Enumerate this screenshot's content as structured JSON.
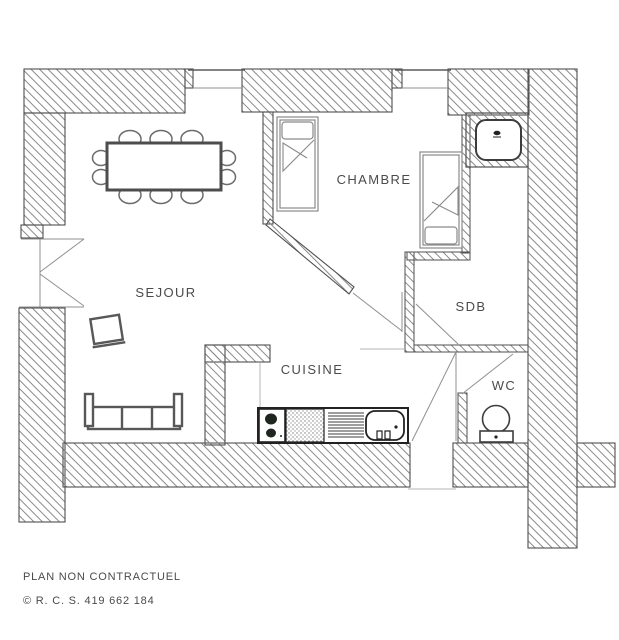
{
  "plan": {
    "rooms": {
      "sejour": {
        "label": "SEJOUR"
      },
      "chambre": {
        "label": "CHAMBRE"
      },
      "cuisine": {
        "label": "CUISINE"
      },
      "sdb": {
        "label": "SDB"
      },
      "wc": {
        "label": "WC"
      }
    },
    "footer": {
      "disclaimer": "PLAN NON CONTRACTUEL",
      "registration": "© R. C. S. 419 662 184"
    },
    "colors": {
      "wall_outline": "#4f4f4f",
      "hatch_line": "#8a8a8a",
      "furniture_line": "#585858",
      "appliance_dark": "#1f261f",
      "label_text": "#4b4b4b",
      "background": "#ffffff"
    }
  }
}
